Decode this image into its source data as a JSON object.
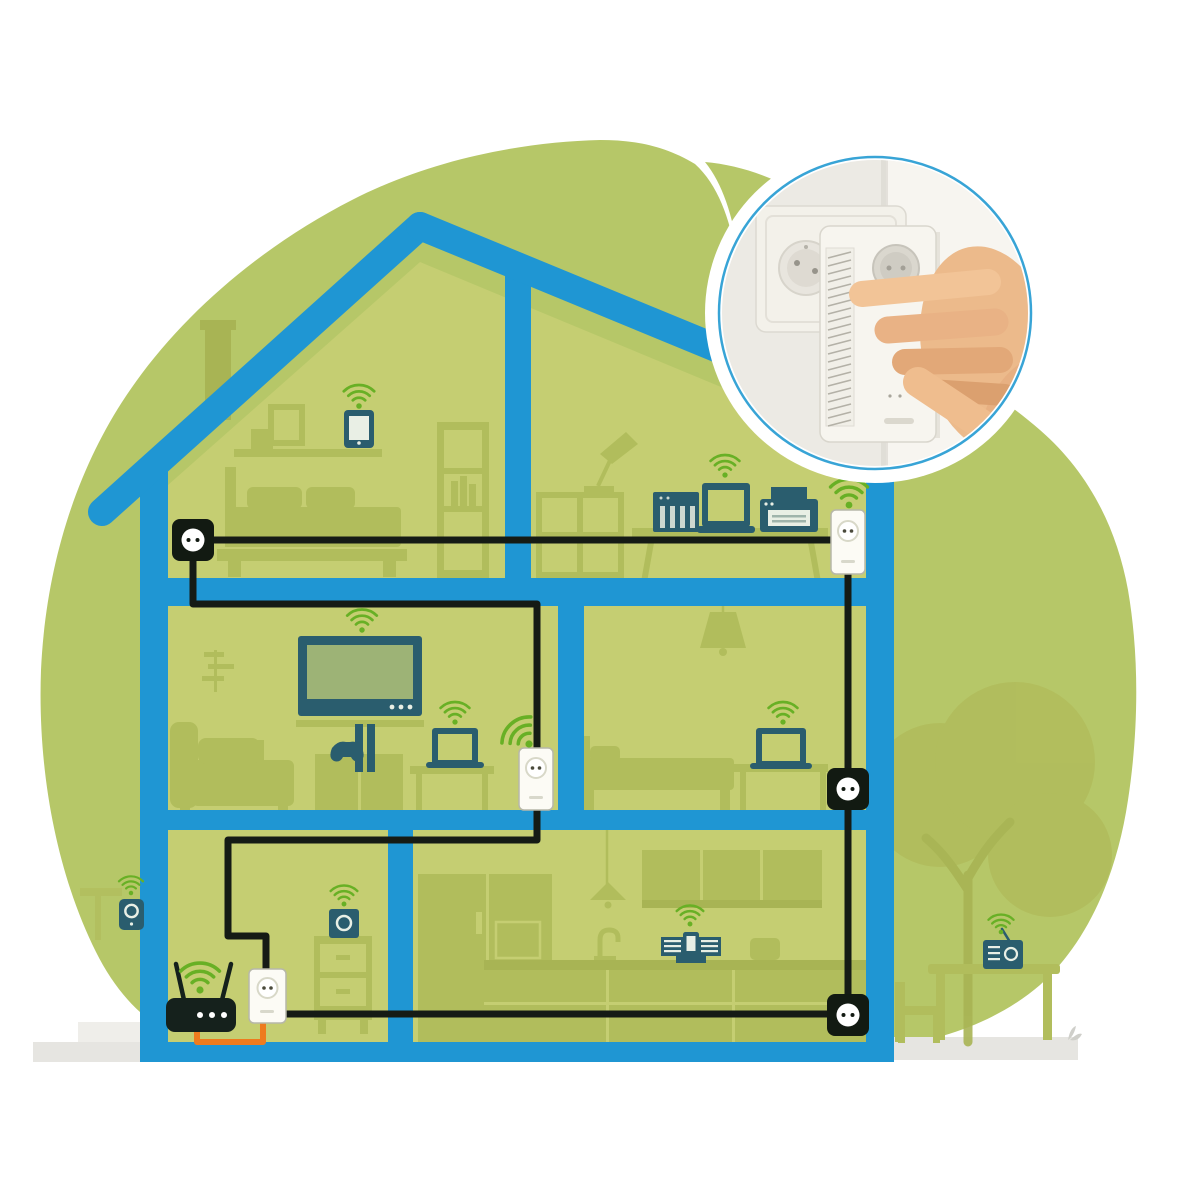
{
  "colors": {
    "background": "#ffffff",
    "cloud_green": "#b6c768",
    "room_green": "#c5ce72",
    "furniture_green": "#b1bd5c",
    "furniture_dark": "#a8b454",
    "house_blue": "#1f96d3",
    "device_teal": "#2a5d6e",
    "router_black": "#15211c",
    "wifi_green": "#68b025",
    "cable_black": "#151b15",
    "cable_orange": "#ee7b1e",
    "socket_black": "#121a12",
    "adapter_white": "#fcfbf5",
    "ground_grey": "#e6e5e1",
    "inset_border_blue": "#38a4d6",
    "skin_tone": "#ecba8b"
  },
  "scene": {
    "type": "cutaway-house-powerline-wifi-network-illustration",
    "inset": {
      "shape": "circle",
      "depicts": "hand-plugging-powerline-adapter-into-double-wall-socket"
    },
    "rooms": {
      "attic_bedroom": {
        "devices": [
          "tablet-with-wifi",
          "wall-socket"
        ],
        "furniture": [
          "chimney",
          "picture-frame",
          "shelf",
          "bed",
          "bookcase"
        ]
      },
      "attic_office": {
        "devices": [
          "nas",
          "laptop-with-wifi",
          "printer",
          "powerline-adapter-with-wifi"
        ],
        "furniture": [
          "desk-lamp",
          "shelving-unit",
          "desk"
        ]
      },
      "living_room": {
        "devices": [
          "tv-with-wifi",
          "game-console",
          "laptop-with-wifi",
          "powerline-adapter-with-wifi"
        ],
        "furniture": [
          "plant",
          "sofa",
          "tv-cabinet",
          "side-table"
        ]
      },
      "bedroom": {
        "devices": [
          "laptop-with-wifi",
          "wall-socket"
        ],
        "furniture": [
          "ceiling-lamp",
          "bed",
          "desk"
        ]
      },
      "utility_room": {
        "devices": [
          "wifi-router",
          "powerline-adapter",
          "smart-speaker-with-wifi"
        ],
        "furniture": [
          "drawer-cabinet"
        ]
      },
      "kitchen": {
        "devices": [
          "music-dock-with-wifi",
          "wall-socket"
        ],
        "furniture": [
          "fridge",
          "pendant-lamp",
          "upper-cabinets",
          "faucet",
          "toaster",
          "counter"
        ]
      },
      "outside_left": {
        "devices": [
          "outdoor-camera-with-wifi"
        ],
        "furniture": [
          "sign",
          "steps"
        ]
      },
      "outside_right": {
        "devices": [
          "radio-with-wifi"
        ],
        "furniture": [
          "tree",
          "garden-table",
          "garden-chair",
          "sprout"
        ]
      }
    },
    "cables": {
      "powerline_ring": "black",
      "router_to_adapter": "orange"
    }
  }
}
